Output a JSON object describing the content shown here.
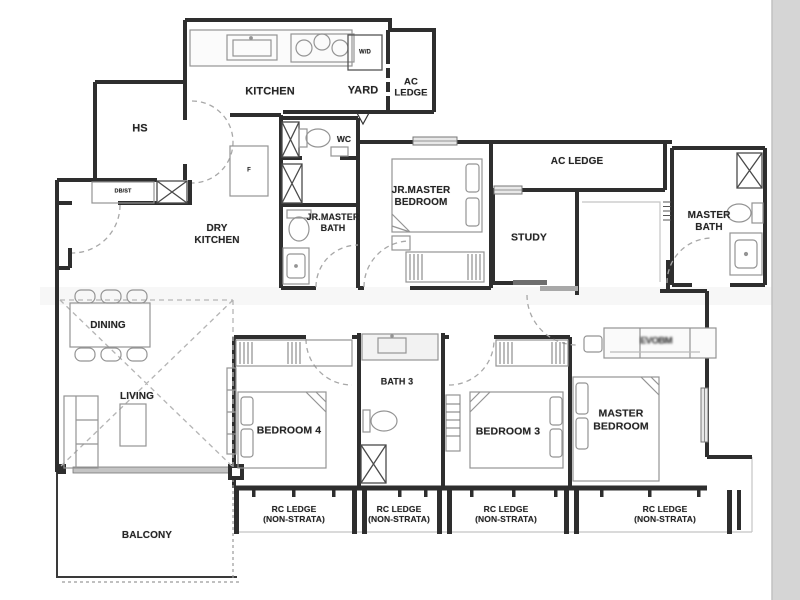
{
  "figure": {
    "type": "floorplan",
    "units_visible": false
  },
  "colors": {
    "background": "#ffffff",
    "wall": "#2e2e2e",
    "furniture": "#949494",
    "dashed_door": "#a8a8a8",
    "void_dash": "#b5b5b5",
    "window_fill": "#e8e8e8",
    "scan_edge": "#d5d5d5",
    "text": "#262626"
  },
  "plan": {
    "labels": [
      {
        "id": "hs",
        "text": "HS",
        "x": 140,
        "y": 129,
        "size": 11
      },
      {
        "id": "kitchen",
        "text": "KITCHEN",
        "x": 270,
        "y": 92,
        "size": 11
      },
      {
        "id": "yard",
        "text": "YARD",
        "x": 363,
        "y": 91,
        "size": 11
      },
      {
        "id": "ac-ledge-top",
        "text": "AC\nLEDGE",
        "x": 411,
        "y": 88,
        "size": 9.5
      },
      {
        "id": "wd",
        "text": "W/D",
        "x": 365,
        "y": 53,
        "size": 6
      },
      {
        "id": "wc",
        "text": "WC",
        "x": 344,
        "y": 139,
        "size": 8.5
      },
      {
        "id": "dbst",
        "text": "DB/ST",
        "x": 123,
        "y": 192,
        "size": 5.5
      },
      {
        "id": "fridge",
        "text": "F",
        "x": 249,
        "y": 171,
        "size": 6
      },
      {
        "id": "dry-kitchen",
        "text": "DRY\nKITCHEN",
        "x": 217,
        "y": 235,
        "size": 10
      },
      {
        "id": "jr-master-bath",
        "text": "JR.MASTER\nBATH",
        "x": 333,
        "y": 223,
        "size": 9
      },
      {
        "id": "jr-master-bedroom",
        "text": "JR.MASTER\nBEDROOM",
        "x": 421,
        "y": 197,
        "size": 10
      },
      {
        "id": "ac-ledge-mid",
        "text": "AC LEDGE",
        "x": 577,
        "y": 162,
        "size": 10
      },
      {
        "id": "study",
        "text": "STUDY",
        "x": 529,
        "y": 238,
        "size": 10.5
      },
      {
        "id": "master-bath",
        "text": "MASTER\nBATH",
        "x": 709,
        "y": 222,
        "size": 10
      },
      {
        "id": "dining",
        "text": "DINING",
        "x": 108,
        "y": 326,
        "size": 10
      },
      {
        "id": "living",
        "text": "LIVING",
        "x": 137,
        "y": 397,
        "size": 10
      },
      {
        "id": "balcony",
        "text": "BALCONY",
        "x": 147,
        "y": 536,
        "size": 10
      },
      {
        "id": "bath-3",
        "text": "BATH 3",
        "x": 397,
        "y": 382,
        "size": 9
      },
      {
        "id": "bedroom-4",
        "text": "BEDROOM 4",
        "x": 289,
        "y": 431,
        "size": 10.5
      },
      {
        "id": "bedroom-3",
        "text": "BEDROOM 3",
        "x": 508,
        "y": 432,
        "size": 10.5
      },
      {
        "id": "master-bedroom",
        "text": "MASTER\nBEDROOM",
        "x": 621,
        "y": 420,
        "size": 10.5
      },
      {
        "id": "rc-ledge-1",
        "text": "RC LEDGE\n(NON-STRATA)",
        "x": 294,
        "y": 514,
        "size": 8.5
      },
      {
        "id": "rc-ledge-2",
        "text": "RC LEDGE\n(NON-STRATA)",
        "x": 399,
        "y": 514,
        "size": 8.5
      },
      {
        "id": "rc-ledge-3",
        "text": "RC LEDGE\n(NON-STRATA)",
        "x": 506,
        "y": 514,
        "size": 8.5
      },
      {
        "id": "rc-ledge-4",
        "text": "RC LEDGE\n(NON-STRATA)",
        "x": 665,
        "y": 514,
        "size": 8.5
      },
      {
        "id": "illegible-stamp",
        "text": "EVOBM",
        "x": 656,
        "y": 341,
        "size": 9.5,
        "blur": true
      }
    ]
  }
}
